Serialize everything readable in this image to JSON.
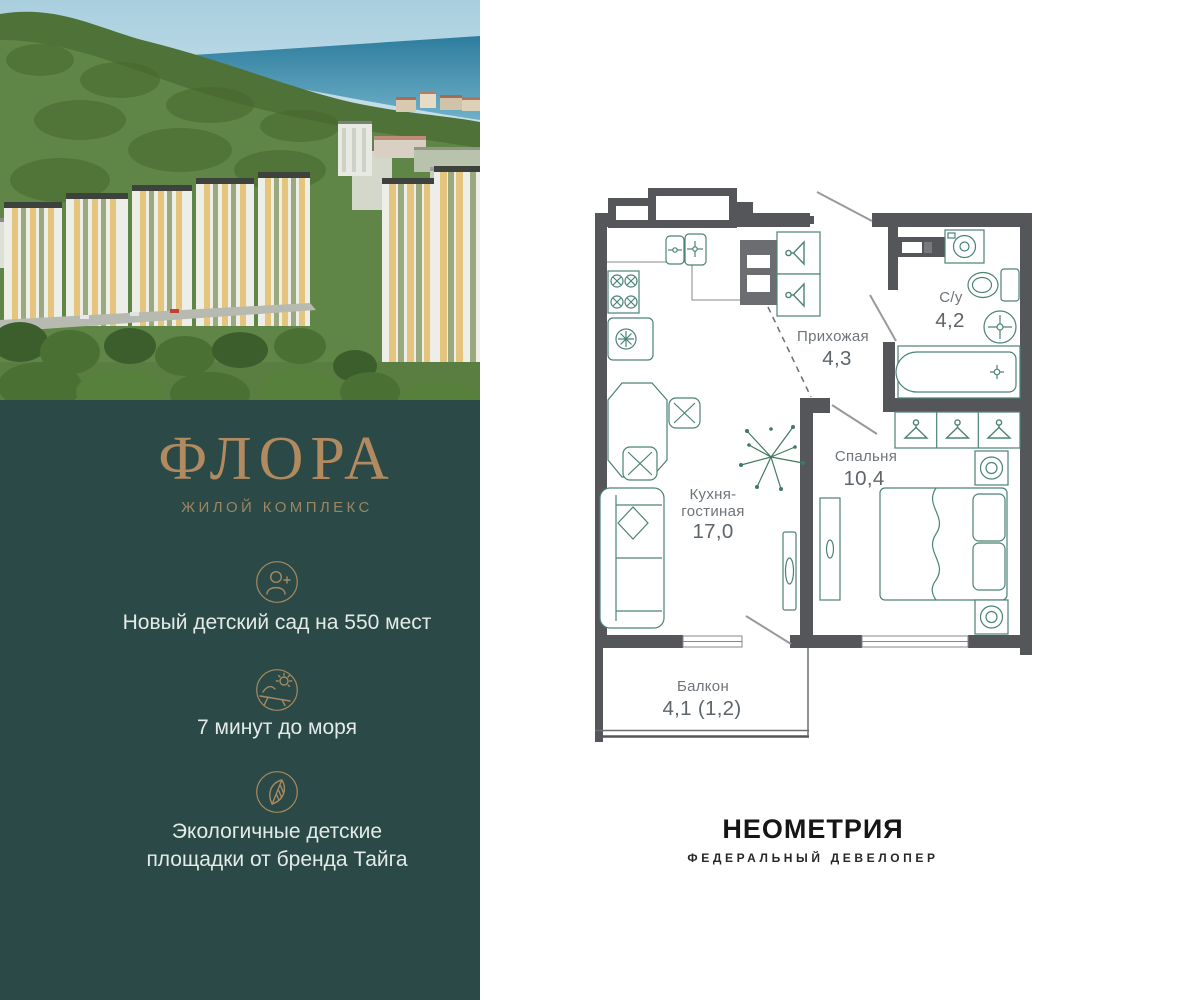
{
  "left_panel": {
    "photo": "aerial-view-of-residential-complex-with-forest-and-sea",
    "brand": {
      "title": "ФЛОРА",
      "subtitle": "ЖИЛОЙ КОМПЛЕКС"
    },
    "features": [
      {
        "icon": "person-add-icon",
        "lines": [
          "Новый детский сад на 550 мест"
        ]
      },
      {
        "icon": "sun-lounger-icon",
        "lines": [
          "7 минут до моря"
        ]
      },
      {
        "icon": "leaf-icon",
        "lines": [
          "Экологичные детские",
          "площадки от бренда Тайга"
        ]
      }
    ]
  },
  "floorplan": {
    "rooms": [
      {
        "name_lines": [
          "Кухня-",
          "гостиная"
        ],
        "area": "17,0"
      },
      {
        "name_lines": [
          "Прихожая"
        ],
        "area": "4,3"
      },
      {
        "name_lines": [
          "С/у"
        ],
        "area": "4,2"
      },
      {
        "name_lines": [
          "Спальня"
        ],
        "area": "10,4"
      },
      {
        "name_lines": [
          "Балкон"
        ],
        "area": "4,1 (1,2)"
      }
    ]
  },
  "developer": {
    "name": "НЕОМЕТРИЯ",
    "tagline": "ФЕДЕРАЛЬНЫЙ ДЕВЕЛОПЕР"
  },
  "colors": {
    "panel_teal": "#2b4946",
    "gold": "#b18a5f",
    "wall_gray": "#54565a",
    "furniture_green": "#4a8374",
    "label_gray": "#6d757a"
  }
}
